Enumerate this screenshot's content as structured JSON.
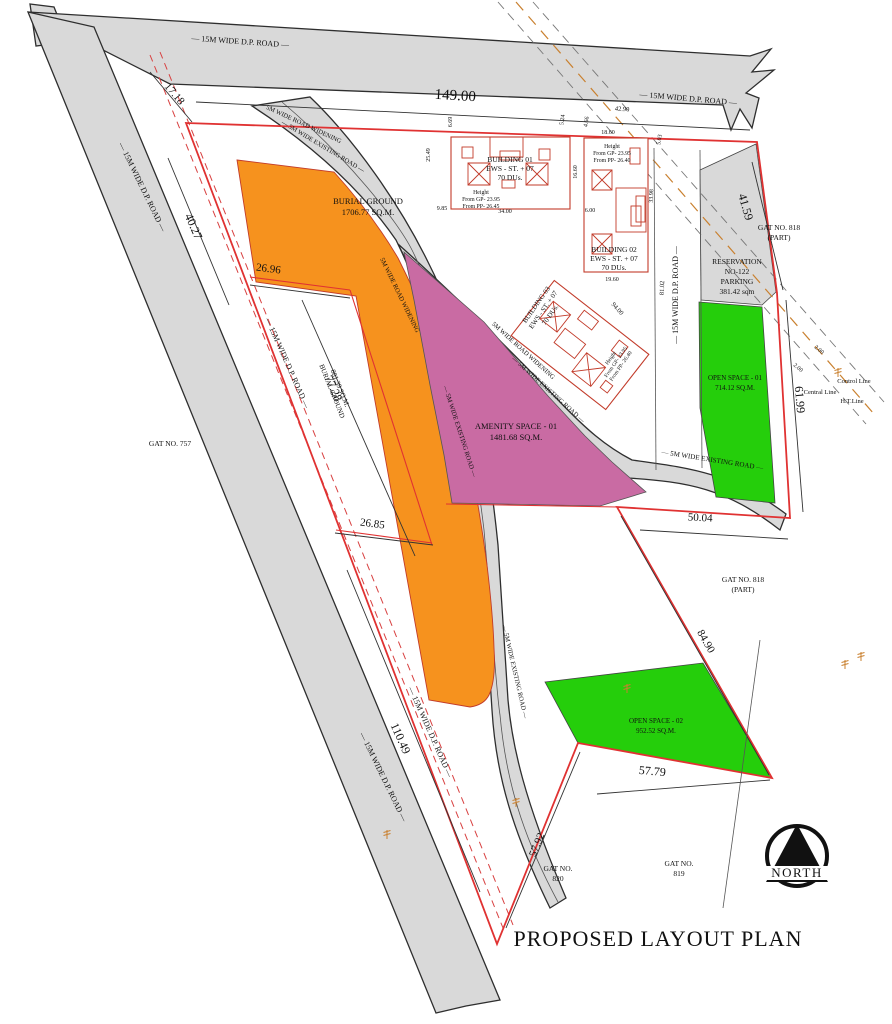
{
  "title": "PROPOSED LAYOUT PLAN",
  "north_label": "NORTH",
  "colors": {
    "road_gray": "#D9D9D9",
    "orange": "#F6921E",
    "pink": "#C96BA3",
    "green": "#25CE0B",
    "boundary_red": "#E03232",
    "dashed_red": "#D84040",
    "label_brown": "#8C3D10",
    "building_red": "#C23B2A",
    "pole_orange": "#C9802F"
  },
  "roads": {
    "dp15": "— 15M WIDE D.P. ROAD —",
    "existing5": "— 5M WIDE EXISTING ROAD —",
    "widening5": "5M WIDE ROAD WIDENING"
  },
  "parcels": {
    "burial": {
      "l1": "BURIAL GROUND",
      "l2": "1706.77 SQ.M."
    },
    "burial_strip": {
      "l1": "BURIAL GROUND",
      "l2": "881.39 SQ.M."
    },
    "amenity": {
      "l1": "AMENITY SPACE - 01",
      "l2": "1481.68 SQ.M."
    },
    "open1": {
      "l1": "OPEN SPACE - 01",
      "l2": "714.12 SQ.M."
    },
    "open2": {
      "l1": "OPEN SPACE - 02",
      "l2": "952.52 SQ.M."
    },
    "reservation": {
      "l1": "RESERVATION",
      "l2": "NO-122",
      "l3": "PARKING",
      "l4": "381.42 sqm"
    }
  },
  "buildings": {
    "b1": {
      "name": "BUILDING 01",
      "spec": "EWS - ST. + 07",
      "units": "70 DUs.",
      "h1": "Height",
      "h2": "From GP- 23.95",
      "h3": "From PP- 26.45"
    },
    "b2": {
      "name": "BUILDING 02",
      "spec": "EWS - ST. + 07",
      "units": "70 DUs.",
      "h1": "Height",
      "h2": "From GP- 23.95",
      "h3": "From PP- 26.40"
    },
    "b3": {
      "name": "BUILDING 03",
      "spec": "EWS - ST. + 07",
      "units": "70 DUs.",
      "h1": "Height",
      "h2": "From GP- 23.95",
      "h3": "From PP- 26.40"
    }
  },
  "dims": {
    "d149": "149.00",
    "d42_90": "42.90",
    "d17_18": "17.18",
    "d40_27": "40.27",
    "d26_96": "26.96",
    "d77_28": "77.28",
    "d26_85": "26.85",
    "d110_49": "110.49",
    "d57_92": "57.92",
    "d57_79": "57.79",
    "d84_90": "84.90",
    "d50_04": "50.04",
    "d61_99": "61.99",
    "d41_59": "41.59",
    "d94_00": "94.00",
    "d81_02": "81.02",
    "d19_60": "19.60",
    "d34_00": "34.00",
    "d9_85": "9.85",
    "d6_00": "6.00",
    "d25_49": "25.49",
    "d6_69": "6.69",
    "d5_24": "5.24",
    "d4_66": "4.66",
    "d18_60": "18.60",
    "d5_03": "5.03",
    "d16_60": "16.60",
    "d33_98": "33.98",
    "d2_00": "2.00"
  },
  "gat": {
    "g757": "GAT NO. 757",
    "g818": "GAT NO. 818",
    "part": "(PART)",
    "gatno": "GAT NO.",
    "g819": "819",
    "g820": "820"
  },
  "ref_lines": {
    "control": "Control Line",
    "central": "Central Line",
    "ht": "H.T.Line"
  }
}
